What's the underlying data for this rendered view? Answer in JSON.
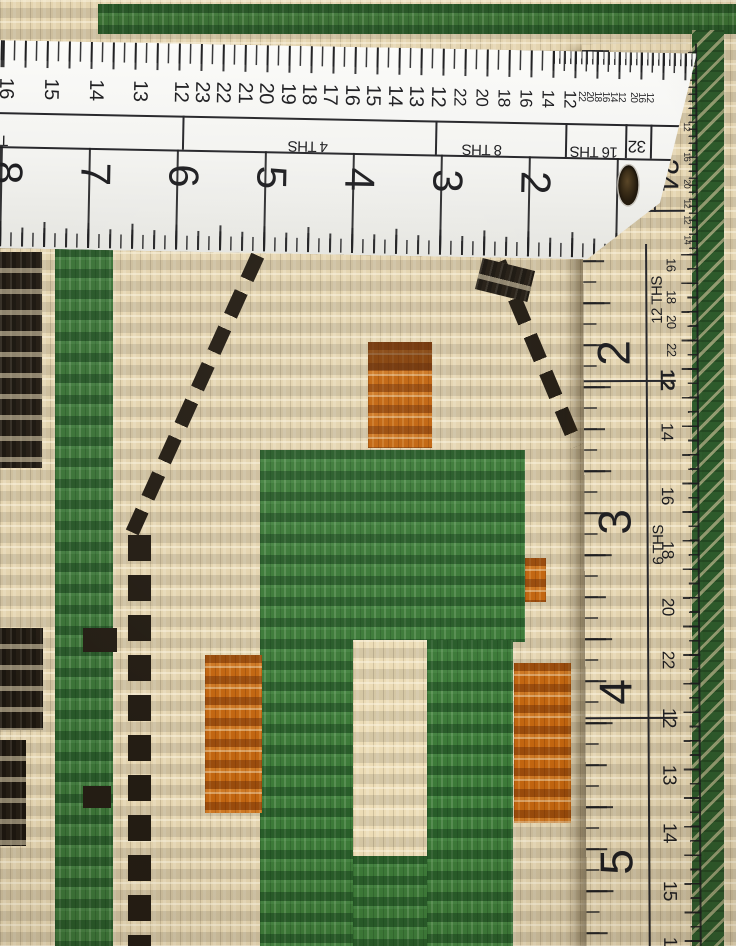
{
  "scene": {
    "description": "Close-up photograph of a hand-knotted wool rug being measured by two white rulers: one horizontal ruler across the top and one vertical ruler along the right edge",
    "palette": {
      "rug_field_cream": "#e4d4af",
      "rug_green": "#3c7a38",
      "rug_dark_green_border": "#2d5a2b",
      "rug_orange": "#c2650f",
      "rug_black": "#241d14",
      "ruler_white": "#f5f5f2",
      "ruler_markings": "#1d1d20",
      "hanging_hole_brown": "#3a2c16"
    }
  },
  "horizontal_ruler": {
    "ths_scale_labels": [
      "4 THS",
      "8 THS",
      "16 THS",
      "32"
    ],
    "inch_numbers": [
      "8",
      "7",
      "6",
      "5",
      "4",
      "3",
      "2"
    ],
    "top_numbers": [
      {
        "t": "16",
        "x": 13,
        "y": 48,
        "s": 20,
        "r": 90
      },
      {
        "t": "15",
        "x": 58,
        "y": 48,
        "s": 20,
        "r": 90
      },
      {
        "t": "14",
        "x": 103,
        "y": 48,
        "s": 20,
        "r": 90
      },
      {
        "t": "13",
        "x": 147,
        "y": 48,
        "s": 20,
        "r": 90
      },
      {
        "t": "12",
        "x": 188,
        "y": 48,
        "s": 20,
        "r": 90
      },
      {
        "t": "23",
        "x": 209,
        "y": 48,
        "s": 20,
        "r": 90
      },
      {
        "t": "22",
        "x": 230,
        "y": 48,
        "s": 20,
        "r": 90
      },
      {
        "t": "21",
        "x": 252,
        "y": 48,
        "s": 20,
        "r": 90
      },
      {
        "t": "20",
        "x": 273,
        "y": 48,
        "s": 20,
        "r": 90
      },
      {
        "t": "19",
        "x": 295,
        "y": 48,
        "s": 20,
        "r": 90
      },
      {
        "t": "18",
        "x": 316,
        "y": 48,
        "s": 20,
        "r": 90
      },
      {
        "t": "17",
        "x": 337,
        "y": 48,
        "s": 20,
        "r": 90
      },
      {
        "t": "16",
        "x": 359,
        "y": 48,
        "s": 20,
        "r": 90
      },
      {
        "t": "15",
        "x": 380,
        "y": 48,
        "s": 20,
        "r": 90
      },
      {
        "t": "14",
        "x": 402,
        "y": 48,
        "s": 20,
        "r": 90
      },
      {
        "t": "13",
        "x": 423,
        "y": 48,
        "s": 20,
        "r": 90
      },
      {
        "t": "12",
        "x": 445,
        "y": 48,
        "s": 20,
        "r": 90
      },
      {
        "t": "22",
        "x": 467,
        "y": 48,
        "s": 17,
        "r": 90
      },
      {
        "t": "20",
        "x": 489,
        "y": 48,
        "s": 17,
        "r": 90
      },
      {
        "t": "18",
        "x": 511,
        "y": 48,
        "s": 17,
        "r": 90
      },
      {
        "t": "16",
        "x": 533,
        "y": 48,
        "s": 17,
        "r": 90
      },
      {
        "t": "14",
        "x": 555,
        "y": 48,
        "s": 17,
        "r": 90
      },
      {
        "t": "12",
        "x": 577,
        "y": 48,
        "s": 17,
        "r": 90
      },
      {
        "t": "22",
        "x": 588,
        "y": 45,
        "s": 10,
        "r": 90
      },
      {
        "t": "20",
        "x": 596,
        "y": 45,
        "s": 10,
        "r": 90
      },
      {
        "t": "18",
        "x": 604,
        "y": 45,
        "s": 10,
        "r": 90
      },
      {
        "t": "16",
        "x": 612,
        "y": 45,
        "s": 10,
        "r": 90
      },
      {
        "t": "14",
        "x": 620,
        "y": 45,
        "s": 10,
        "r": 90
      },
      {
        "t": "12",
        "x": 628,
        "y": 45,
        "s": 10,
        "r": 90
      },
      {
        "t": "20",
        "x": 640,
        "y": 45,
        "s": 10,
        "r": 90
      },
      {
        "t": "16",
        "x": 648,
        "y": 45,
        "s": 10,
        "r": 90
      },
      {
        "t": "12",
        "x": 656,
        "y": 45,
        "s": 10,
        "r": 90
      }
    ],
    "inch_number_items": [
      {
        "t": "8",
        "x": 16,
        "y": 132,
        "s": 42,
        "r": 90
      },
      {
        "t": "7",
        "x": 104,
        "y": 132,
        "s": 42,
        "r": 90
      },
      {
        "t": "6",
        "x": 192,
        "y": 132,
        "s": 42,
        "r": 90
      },
      {
        "t": "5",
        "x": 280,
        "y": 132,
        "s": 42,
        "r": 90
      },
      {
        "t": "4",
        "x": 368,
        "y": 132,
        "s": 42,
        "r": 90
      },
      {
        "t": "3",
        "x": 456,
        "y": 132,
        "s": 42,
        "r": 90
      },
      {
        "t": "2",
        "x": 544,
        "y": 132,
        "s": 42,
        "r": 90
      }
    ],
    "band_label_items": [
      {
        "t": "THS",
        "x": 2,
        "y": 100,
        "s": 15,
        "r": 180
      },
      {
        "t": "4 THS",
        "x": 316,
        "y": 100,
        "s": 15,
        "r": 180
      },
      {
        "t": "8 THS",
        "x": 490,
        "y": 100,
        "s": 15,
        "r": 180
      },
      {
        "t": "16 THS",
        "x": 602,
        "y": 100,
        "s": 15,
        "r": 180
      },
      {
        "t": "32",
        "x": 645,
        "y": 94,
        "s": 17,
        "r": 180
      }
    ]
  },
  "vertical_ruler": {
    "ths_scale_labels": [
      "12 THS",
      "6 THS"
    ],
    "inch_numbers": [
      "2",
      "3",
      "4",
      "5"
    ],
    "corner_number": "24",
    "inch_number_items": [
      {
        "t": "2",
        "x": 30,
        "y": 309,
        "s": 46,
        "r": -90
      },
      {
        "t": "3",
        "x": 30,
        "y": 478,
        "s": 46,
        "r": -90
      },
      {
        "t": "4",
        "x": 30,
        "y": 648,
        "s": 46,
        "r": -90
      },
      {
        "t": "5",
        "x": 30,
        "y": 818,
        "s": 46,
        "r": -90
      }
    ],
    "band_label_items": [
      {
        "t": "12 THS",
        "x": 74,
        "y": 256,
        "s": 15,
        "r": -90
      },
      {
        "t": "6 THS",
        "x": 74,
        "y": 501,
        "s": 15,
        "r": -90
      }
    ],
    "right_scale_items": [
      {
        "t": "16",
        "x": 88,
        "y": 221,
        "s": 13,
        "r": 90
      },
      {
        "t": "18",
        "x": 88,
        "y": 253,
        "s": 13,
        "r": 90
      },
      {
        "t": "20",
        "x": 88,
        "y": 278,
        "s": 13,
        "r": 90
      },
      {
        "t": "22",
        "x": 88,
        "y": 306,
        "s": 13,
        "r": 90
      },
      {
        "t": "12",
        "x": 83,
        "y": 336,
        "s": 20,
        "r": 90,
        "b": 1
      },
      {
        "t": "14",
        "x": 83,
        "y": 388,
        "s": 17,
        "r": 90
      },
      {
        "t": "16",
        "x": 83,
        "y": 452,
        "s": 17,
        "r": 90
      },
      {
        "t": "18",
        "x": 83,
        "y": 506,
        "s": 17,
        "r": 90
      },
      {
        "t": "20",
        "x": 83,
        "y": 563,
        "s": 17,
        "r": 90
      },
      {
        "t": "22",
        "x": 83,
        "y": 616,
        "s": 17,
        "r": 90
      },
      {
        "t": "12",
        "x": 83,
        "y": 674,
        "s": 19,
        "r": 90
      },
      {
        "t": "13",
        "x": 83,
        "y": 731,
        "s": 19,
        "r": 90
      },
      {
        "t": "14",
        "x": 83,
        "y": 789,
        "s": 19,
        "r": 90
      },
      {
        "t": "15",
        "x": 83,
        "y": 847,
        "s": 19,
        "r": 90
      },
      {
        "t": "16",
        "x": 83,
        "y": 903,
        "s": 19,
        "r": 90
      }
    ],
    "corner_items": [
      {
        "t": "24",
        "x": 84,
        "y": 131,
        "s": 30,
        "r": 90
      }
    ],
    "top_tiny_items": [
      {
        "t": "12",
        "x": 104,
        "y": 83,
        "s": 9,
        "r": 90
      },
      {
        "t": "16",
        "x": 104,
        "y": 113,
        "s": 9,
        "r": 90
      },
      {
        "t": "20",
        "x": 104,
        "y": 140,
        "s": 9,
        "r": 90
      },
      {
        "t": "12",
        "x": 104,
        "y": 160,
        "s": 9,
        "r": 90
      },
      {
        "t": "12",
        "x": 104,
        "y": 176,
        "s": 9,
        "r": 90
      },
      {
        "t": "14",
        "x": 104,
        "y": 196,
        "s": 9,
        "r": 90
      }
    ]
  }
}
